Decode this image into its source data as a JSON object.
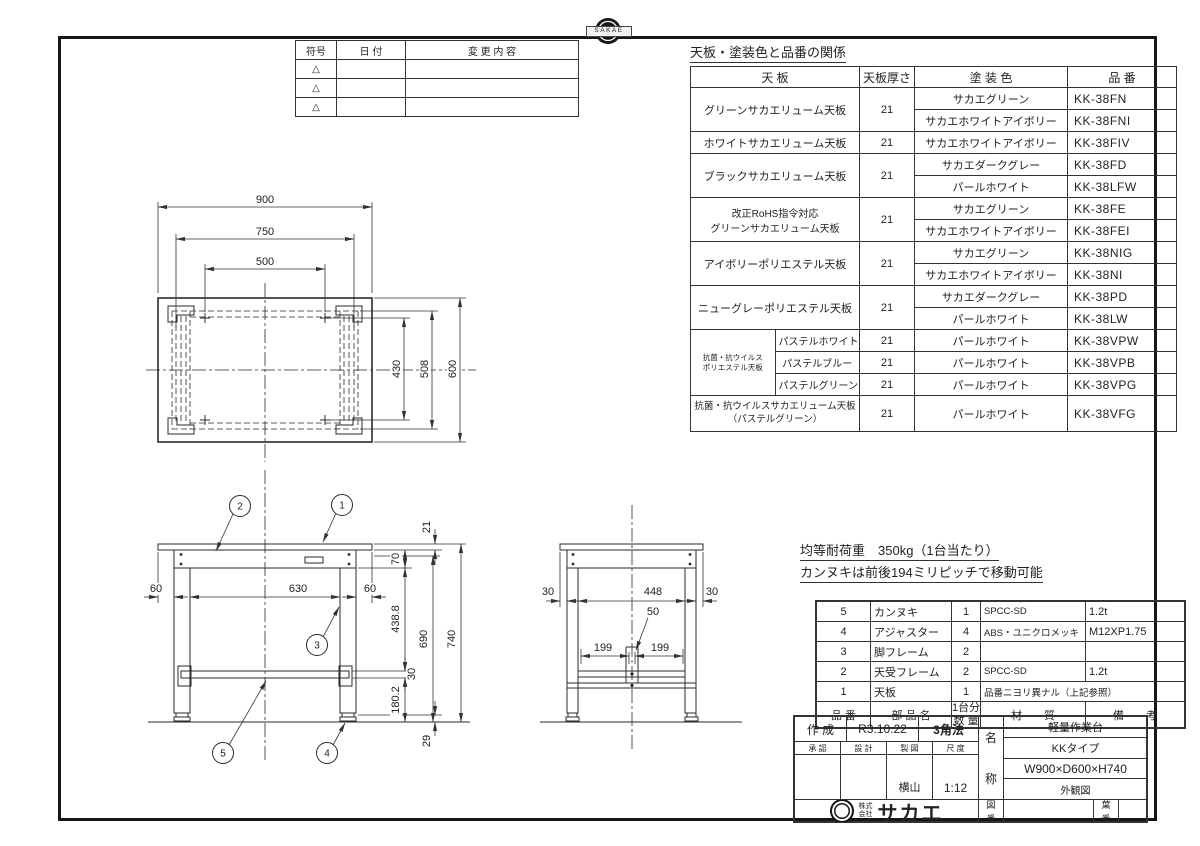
{
  "revision_table": {
    "headers": [
      "符号",
      "日  付",
      "変 更 内 容"
    ],
    "symbol": "△",
    "rows": 3
  },
  "paint_table": {
    "title": "天板・塗装色と品番の関係",
    "headers": {
      "tenban": "天  板",
      "thickness": "天板厚さ",
      "color": "塗  装  色",
      "code": "品  番"
    },
    "groups": [
      {
        "tenban": "グリーンサカエリューム天板",
        "thickness": "21",
        "rows": [
          {
            "color": "サカエグリーン",
            "code": "KK-38FN"
          },
          {
            "color": "サカエホワイトアイボリー",
            "code": "KK-38FNI"
          }
        ]
      },
      {
        "tenban": "ホワイトサカエリューム天板",
        "thickness": "21",
        "rows": [
          {
            "color": "サカエホワイトアイボリー",
            "code": "KK-38FIV"
          }
        ]
      },
      {
        "tenban": "ブラックサカエリューム天板",
        "thickness": "21",
        "rows": [
          {
            "color": "サカエダークグレー",
            "code": "KK-38FD"
          },
          {
            "color": "パールホワイト",
            "code": "KK-38LFW"
          }
        ]
      },
      {
        "tenban_l1": "改正RoHS指令対応",
        "tenban_l2": "グリーンサカエリューム天板",
        "thickness": "21",
        "rows": [
          {
            "color": "サカエグリーン",
            "code": "KK-38FE"
          },
          {
            "color": "サカエホワイトアイボリー",
            "code": "KK-38FEI"
          }
        ]
      },
      {
        "tenban": "アイボリーポリエステル天板",
        "thickness": "21",
        "rows": [
          {
            "color": "サカエグリーン",
            "code": "KK-38NIG"
          },
          {
            "color": "サカエホワイトアイボリー",
            "code": "KK-38NI"
          }
        ]
      },
      {
        "tenban": "ニューグレーポリエステル天板",
        "thickness": "21",
        "rows": [
          {
            "color": "サカエダークグレー",
            "code": "KK-38PD"
          },
          {
            "color": "パールホワイト",
            "code": "KK-38LW"
          }
        ]
      },
      {
        "label_l1": "抗菌・抗ウイルス",
        "label_l2": "ポリエステル天板",
        "rows": [
          {
            "sub": "パステルホワイト",
            "thickness": "21",
            "color": "パールホワイト",
            "code": "KK-38VPW"
          },
          {
            "sub": "パステルブルー",
            "thickness": "21",
            "color": "パールホワイト",
            "code": "KK-38VPB"
          },
          {
            "sub": "パステルグリーン",
            "thickness": "21",
            "color": "パールホワイト",
            "code": "KK-38VPG"
          }
        ]
      },
      {
        "tenban_l1": "抗菌・抗ウイルスサカエリューム天板",
        "tenban_l2": "（パステルグリーン）",
        "thickness": "21",
        "rows": [
          {
            "color": "パールホワイト",
            "code": "KK-38VFG"
          }
        ]
      }
    ]
  },
  "notes": {
    "line1": "均等耐荷重　350kg（1台当たり）",
    "line2": "カンヌキは前後194ミリピッチで移動可能"
  },
  "parts_table": {
    "header": {
      "no": "品 番",
      "name": "部  品  名",
      "qty1": "1台分",
      "qty2": "数 量",
      "mat": "材　　質",
      "note": "備　　考"
    },
    "rows": [
      {
        "no": "5",
        "name": "カンヌキ",
        "qty": "1",
        "mat": "SPCC-SD",
        "note": "1.2t"
      },
      {
        "no": "4",
        "name": "アジャスター",
        "qty": "4",
        "mat": "ABS・ユニクロメッキ",
        "note": "M12XP1.75"
      },
      {
        "no": "3",
        "name": "脚フレーム",
        "qty": "2",
        "mat": "",
        "note": ""
      },
      {
        "no": "2",
        "name": "天受フレーム",
        "qty": "2",
        "mat": "SPCC-SD",
        "note": "1.2t"
      },
      {
        "no": "1",
        "name": "天板",
        "qty": "1",
        "mat_span": "品番ニヨリ異ナル（上記参照）"
      }
    ]
  },
  "title_block": {
    "created_label": "作 成",
    "created_date": "R3.10.22",
    "projection": "3角法",
    "approve": "承 認",
    "design": "設 計",
    "draft": "製 図",
    "scale_label": "尺 度",
    "drafter": "横山",
    "scale": "1:12",
    "name_top": "名",
    "name_bottom": "称",
    "product": "軽量作業台",
    "type": "KKタイプ",
    "size": "W900×D600×H740",
    "view": "外観図",
    "company_prefix_1": "株式",
    "company_prefix_2": "会社",
    "company": "サカエ",
    "zuban_1": "図",
    "zuban_2": "番",
    "yoban_1": "葉",
    "yoban_2": "番"
  },
  "badge": {
    "text": "SAKAE"
  },
  "dims": {
    "plan": {
      "overall_w": "900",
      "frame_w": "750",
      "pitch_w": "500",
      "inner_d": "430",
      "frame_d": "508",
      "overall_d": "600"
    },
    "front": {
      "top_thickness": "21",
      "apron_h": "70",
      "overhang_l": "60",
      "inner_w": "630",
      "overhang_r": "60",
      "leg_span": "438.8",
      "under_top_h": "690",
      "overall_h": "740",
      "bar_h": "30",
      "lower_h": "180.2",
      "adjuster_h": "29"
    },
    "side": {
      "overhang_l": "30",
      "inner_d": "448",
      "overhang_r": "30",
      "bar_w": "50",
      "pitch_l": "199",
      "pitch_r": "199"
    },
    "callouts": [
      "1",
      "2",
      "3",
      "4",
      "5"
    ]
  }
}
